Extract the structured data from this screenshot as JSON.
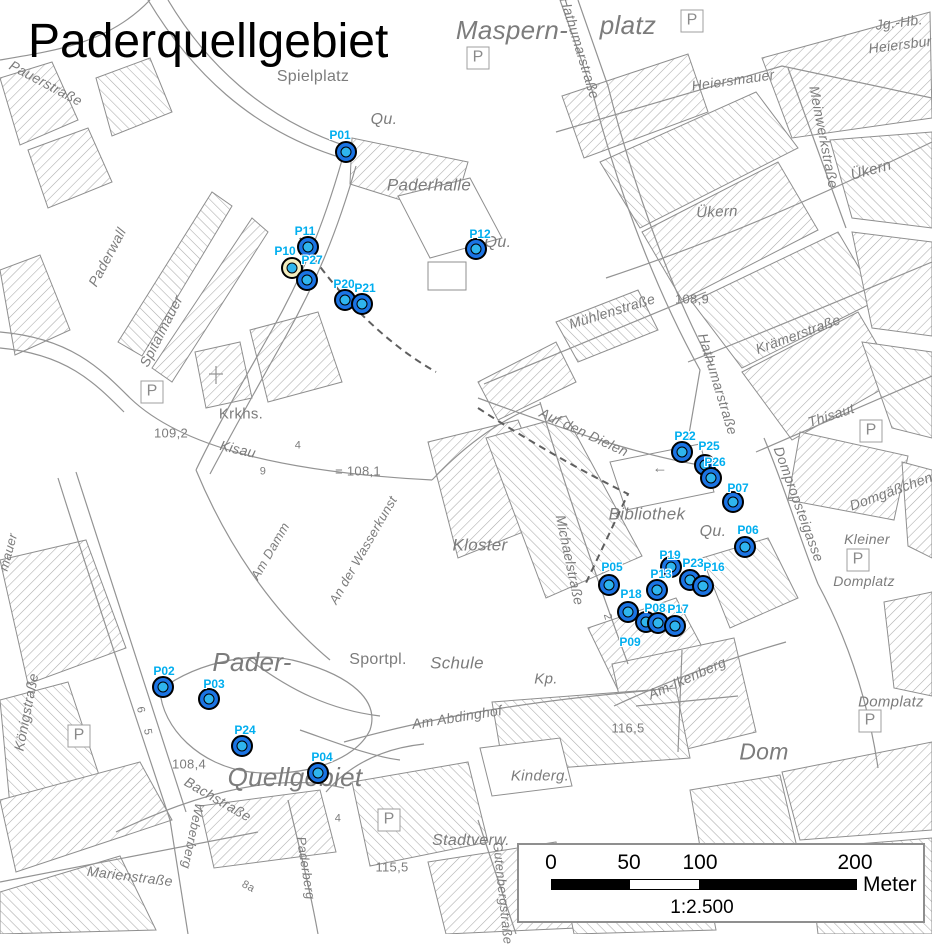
{
  "title": "Paderquellgebiet",
  "colors": {
    "marker_ring": "#1b74e4",
    "marker_core": "#2fb5ee",
    "marker_yellow": "#f3edbe",
    "point_label": "#00aeef",
    "map_gray": "#7c7c7c"
  },
  "parking_label": "P",
  "parking": [
    {
      "x": 478,
      "y": 58
    },
    {
      "x": 692,
      "y": 21
    },
    {
      "x": 152,
      "y": 392
    },
    {
      "x": 871,
      "y": 431
    },
    {
      "x": 858,
      "y": 560
    },
    {
      "x": 870,
      "y": 721
    },
    {
      "x": 389,
      "y": 820
    },
    {
      "x": 79,
      "y": 736
    }
  ],
  "map_labels": [
    {
      "t": "Spielplatz",
      "x": 313,
      "y": 77,
      "fs": 16
    },
    {
      "t": "Qu.",
      "x": 384,
      "y": 120,
      "fs": 16,
      "it": 1
    },
    {
      "t": "Paderhalle",
      "x": 429,
      "y": 185,
      "fs": 17,
      "it": 1
    },
    {
      "t": "Maspern-",
      "x": 512,
      "y": 30,
      "fs": 26,
      "it": 1
    },
    {
      "t": "platz",
      "x": 628,
      "y": 25,
      "fs": 26,
      "it": 1
    },
    {
      "t": "Jg.-Hb.",
      "x": 899,
      "y": 22,
      "fs": 14,
      "it": 1,
      "r": -7
    },
    {
      "t": "Heiersburg",
      "x": 904,
      "y": 44,
      "fs": 14,
      "it": 1,
      "r": -7
    },
    {
      "t": "Heiersmauer",
      "x": 733,
      "y": 80,
      "fs": 14,
      "it": 1,
      "r": -8
    },
    {
      "t": "Meinwerkstraße",
      "x": 824,
      "y": 137,
      "fs": 14,
      "it": 1,
      "r": 79
    },
    {
      "t": "Ükern",
      "x": 871,
      "y": 170,
      "fs": 15,
      "it": 1,
      "r": -15
    },
    {
      "t": "Ükern",
      "x": 717,
      "y": 212,
      "fs": 15,
      "it": 1,
      "r": -2
    },
    {
      "t": "Hathumarstraße",
      "x": 580,
      "y": 48,
      "fs": 14,
      "it": 1,
      "r": 73
    },
    {
      "t": "Hathumarstraße",
      "x": 718,
      "y": 384,
      "fs": 14,
      "it": 1,
      "r": 73
    },
    {
      "t": "Mühlenstraße",
      "x": 612,
      "y": 311,
      "fs": 14,
      "it": 1,
      "r": -17
    },
    {
      "t": "108,9",
      "x": 692,
      "y": 299,
      "fs": 13
    },
    {
      "t": "Krämerstraße",
      "x": 798,
      "y": 334,
      "fs": 14,
      "it": 1,
      "r": -20
    },
    {
      "t": "Thisaut",
      "x": 831,
      "y": 415,
      "fs": 14,
      "it": 1,
      "r": -18
    },
    {
      "t": "Domgäßchen",
      "x": 891,
      "y": 491,
      "fs": 14,
      "it": 1,
      "r": -20
    },
    {
      "t": "Dompropsteigasse",
      "x": 799,
      "y": 504,
      "fs": 14,
      "it": 1,
      "r": 70
    },
    {
      "t": "Kleiner",
      "x": 867,
      "y": 539,
      "fs": 14,
      "it": 1
    },
    {
      "t": "Domplatz",
      "x": 864,
      "y": 581,
      "fs": 14,
      "it": 1
    },
    {
      "t": "Domplatz",
      "x": 891,
      "y": 702,
      "fs": 15,
      "it": 1
    },
    {
      "t": "Auf den Dielen",
      "x": 584,
      "y": 432,
      "fs": 14,
      "it": 1,
      "r": 25
    },
    {
      "t": "Bibliothek",
      "x": 647,
      "y": 514,
      "fs": 17,
      "it": 1
    },
    {
      "t": "Qu.",
      "x": 713,
      "y": 532,
      "fs": 16,
      "it": 1
    },
    {
      "t": "Qu.",
      "x": 498,
      "y": 243,
      "fs": 16,
      "it": 1
    },
    {
      "t": "Kloster",
      "x": 480,
      "y": 545,
      "fs": 17,
      "it": 1
    },
    {
      "t": "Michaelstraße",
      "x": 570,
      "y": 560,
      "fs": 14,
      "it": 1,
      "r": 78
    },
    {
      "t": "Pauerstraße",
      "x": 46,
      "y": 83,
      "fs": 14,
      "it": 1,
      "r": 28
    },
    {
      "t": "Paderwall",
      "x": 107,
      "y": 257,
      "fs": 14,
      "it": 1,
      "r": -62
    },
    {
      "t": "Spitalmauer",
      "x": 161,
      "y": 331,
      "fs": 14,
      "it": 1,
      "r": -63
    },
    {
      "t": "Krkhs.",
      "x": 241,
      "y": 414,
      "fs": 15
    },
    {
      "t": "109,2",
      "x": 171,
      "y": 433,
      "fs": 13
    },
    {
      "t": "Kisau",
      "x": 238,
      "y": 449,
      "fs": 14,
      "it": 1,
      "r": 13
    },
    {
      "t": "= 108,1",
      "x": 358,
      "y": 471,
      "fs": 13
    },
    {
      "t": "Am Damm",
      "x": 270,
      "y": 551,
      "fs": 13,
      "it": 1,
      "r": -60
    },
    {
      "t": "An der Wasserkunst",
      "x": 363,
      "y": 550,
      "fs": 13,
      "it": 1,
      "r": -60
    },
    {
      "t": "mauer",
      "x": 8,
      "y": 552,
      "fs": 13,
      "it": 1,
      "r": -75
    },
    {
      "t": "Königstraße",
      "x": 26,
      "y": 712,
      "fs": 14,
      "it": 1,
      "r": -79
    },
    {
      "t": "Pader-",
      "x": 252,
      "y": 662,
      "fs": 26,
      "it": 1
    },
    {
      "t": "Quellgebiet",
      "x": 295,
      "y": 777,
      "fs": 26,
      "it": 1
    },
    {
      "t": "108,4",
      "x": 189,
      "y": 764,
      "fs": 13
    },
    {
      "t": "Bachstraße",
      "x": 218,
      "y": 799,
      "fs": 14,
      "it": 1,
      "r": 30
    },
    {
      "t": "Weberberg",
      "x": 193,
      "y": 836,
      "fs": 13,
      "it": 1,
      "r": 102
    },
    {
      "t": "Marienstraße",
      "x": 130,
      "y": 876,
      "fs": 14,
      "it": 1,
      "r": 7
    },
    {
      "t": "8a",
      "x": 248,
      "y": 887,
      "fs": 11,
      "r": 28
    },
    {
      "t": "Paderberg",
      "x": 306,
      "y": 868,
      "fs": 13,
      "it": 1,
      "r": 81
    },
    {
      "t": "115,5",
      "x": 392,
      "y": 867,
      "fs": 13
    },
    {
      "t": "Stadtverw.",
      "x": 471,
      "y": 841,
      "fs": 16,
      "it": 1
    },
    {
      "t": "Gutenbergstraße",
      "x": 503,
      "y": 893,
      "fs": 13,
      "it": 1,
      "r": 84
    },
    {
      "t": "Sportpl.",
      "x": 378,
      "y": 660,
      "fs": 16
    },
    {
      "t": "Schule",
      "x": 457,
      "y": 663,
      "fs": 17,
      "it": 1
    },
    {
      "t": "Kp.",
      "x": 546,
      "y": 679,
      "fs": 15,
      "it": 1
    },
    {
      "t": "Am Abdinghof",
      "x": 457,
      "y": 717,
      "fs": 14,
      "it": 1,
      "r": -9
    },
    {
      "t": "Kinderg.",
      "x": 540,
      "y": 776,
      "fs": 15,
      "it": 1
    },
    {
      "t": "Am-Ikenberg",
      "x": 687,
      "y": 678,
      "fs": 14,
      "it": 1,
      "r": -24
    },
    {
      "t": "116,5",
      "x": 628,
      "y": 728,
      "fs": 13
    },
    {
      "t": "Dom",
      "x": 764,
      "y": 752,
      "fs": 23,
      "it": 1
    },
    {
      "t": "9",
      "x": 263,
      "y": 472,
      "fs": 11
    },
    {
      "t": "4",
      "x": 298,
      "y": 446,
      "fs": 11
    },
    {
      "t": "4",
      "x": 338,
      "y": 819,
      "fs": 11
    },
    {
      "t": "6",
      "x": 140,
      "y": 710,
      "fs": 11,
      "r": 80
    },
    {
      "t": "5",
      "x": 147,
      "y": 732,
      "fs": 11,
      "r": 80
    },
    {
      "t": "2",
      "x": 607,
      "y": 617,
      "fs": 11,
      "r": 75
    },
    {
      "t": "←",
      "x": 660,
      "y": 468,
      "fs": 15
    }
  ],
  "points": [
    {
      "id": "P01",
      "x": 346,
      "y": 152,
      "lx": 340,
      "ly": 135
    },
    {
      "id": "P02",
      "x": 163,
      "y": 687,
      "lx": 164,
      "ly": 671
    },
    {
      "id": "P03",
      "x": 209,
      "y": 699,
      "lx": 214,
      "ly": 684
    },
    {
      "id": "P04",
      "x": 318,
      "y": 773,
      "lx": 322,
      "ly": 757
    },
    {
      "id": "P05",
      "x": 609,
      "y": 585,
      "lx": 612,
      "ly": 567
    },
    {
      "id": "P06",
      "x": 745,
      "y": 547,
      "lx": 748,
      "ly": 530
    },
    {
      "id": "P07",
      "x": 733,
      "y": 502,
      "lx": 738,
      "ly": 488
    },
    {
      "id": "P10",
      "x": 292,
      "y": 268,
      "lx": 285,
      "ly": 251,
      "variant": "yellow"
    },
    {
      "id": "P11",
      "x": 308,
      "y": 247,
      "lx": 305,
      "ly": 231
    },
    {
      "id": "P27",
      "x": 307,
      "y": 280,
      "lx": 312,
      "ly": 260
    },
    {
      "id": "P12",
      "x": 476,
      "y": 249,
      "lx": 480,
      "ly": 234
    },
    {
      "id": "P20",
      "x": 345,
      "y": 300,
      "lx": 344,
      "ly": 284
    },
    {
      "id": "P21",
      "x": 362,
      "y": 304,
      "lx": 365,
      "ly": 288
    },
    {
      "id": "P22",
      "x": 682,
      "y": 452,
      "lx": 685,
      "ly": 436
    },
    {
      "id": "P25",
      "x": 705,
      "y": 465,
      "lx": 709,
      "ly": 446
    },
    {
      "id": "P26",
      "x": 711,
      "y": 478,
      "lx": 715,
      "ly": 462
    },
    {
      "id": "P19",
      "x": 671,
      "y": 567,
      "lx": 670,
      "ly": 555
    },
    {
      "id": "P13",
      "x": 657,
      "y": 590,
      "lx": 661,
      "ly": 574
    },
    {
      "id": "P23",
      "x": 690,
      "y": 580,
      "lx": 693,
      "ly": 563
    },
    {
      "id": "P16",
      "x": 703,
      "y": 586,
      "lx": 714,
      "ly": 567
    },
    {
      "id": "P18",
      "x": 628,
      "y": 612,
      "lx": 631,
      "ly": 594
    },
    {
      "id": "P08",
      "x": 646,
      "y": 622,
      "lx": 655,
      "ly": 608
    },
    {
      "id": "P09",
      "x": 658,
      "y": 623,
      "lx": 630,
      "ly": 642
    },
    {
      "id": "P17",
      "x": 675,
      "y": 626,
      "lx": 678,
      "ly": 609
    },
    {
      "id": "P24",
      "x": 242,
      "y": 746,
      "lx": 245,
      "ly": 730
    }
  ],
  "scalebar": {
    "ticks": [
      {
        "t": "0",
        "x": 32
      },
      {
        "t": "50",
        "x": 110
      },
      {
        "t": "100",
        "x": 181
      },
      {
        "t": "200",
        "x": 336
      }
    ],
    "unit": "Meter",
    "ratio": "1:2.500"
  }
}
